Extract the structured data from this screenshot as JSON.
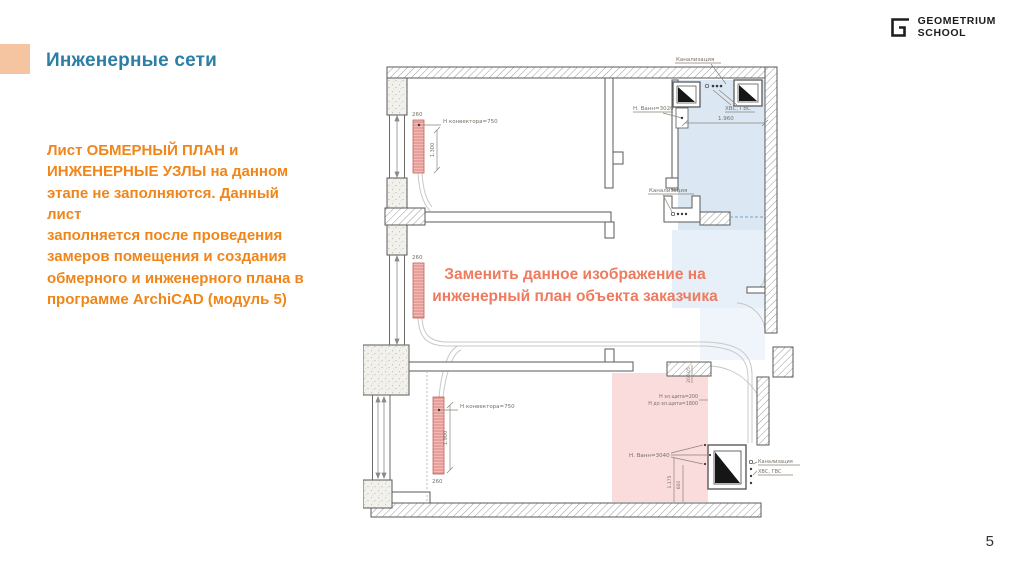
{
  "slide": {
    "title": "Инженерные сети",
    "body_text": "Лист ОБМЕРНЫЙ ПЛАН и\nИНЖЕНЕРНЫЕ УЗЛЫ на данном\nэтапе не заполняются. Данный лист\nзаполняется после проведения\nзамеров помещения и создания\nобмерного и инженерного плана в\nпрограмме ArchiCAD (модуль 5)",
    "page_number": "5",
    "colors": {
      "accent_square": "#f4c5a0",
      "title": "#2b7fa6",
      "body_text": "#f08519",
      "overlay_note": "#ee7b5f",
      "zone_blue": "#dbe8f3",
      "zone_pink": "#fadcdc",
      "radiator": "#f5b8b4"
    }
  },
  "logo": {
    "line1": "GEOMETRIUM",
    "line2": "SCHOOL",
    "mark": "g-bracket-icon"
  },
  "plan": {
    "overlay": {
      "note_line1": "Заменить данное изображение на",
      "note_line2": "инженерный план объекта заказчика"
    },
    "labels": {
      "kanalizaciya_top": "Канализация",
      "hvs_gvs_top": "ХВС, ГВС",
      "dim_1960": "1.960",
      "vann_3020": "Н. Ванн=3020",
      "kanalizaciya_mid": "Канализация",
      "konvektor_top": "Н конвектора=750",
      "dim_1300": "1.300",
      "dim_260_top": "260",
      "dim_260_mid": "260",
      "dim_260_bottom": "260",
      "konvektor_bottom": "Н конвектора=750",
      "dim_1900": "1.900",
      "el_shield_height": "Н эл.щита=200",
      "el_shield_to": "Н до эл.щита=1800",
      "dim_206": "206,05",
      "vann_3040": "Н. Ванн=3040",
      "dim_1175": "1.175",
      "dim_600": "600",
      "kanalizaciya_bottom": "Канализация",
      "hvs_gvs_bottom": "ХВС, ГВС"
    }
  }
}
